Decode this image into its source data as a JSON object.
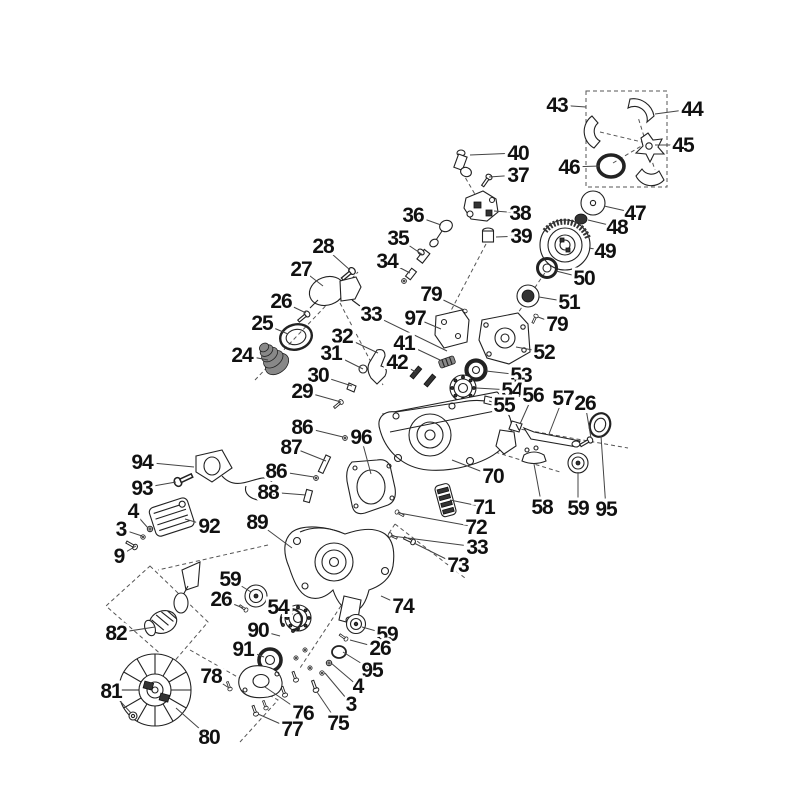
{
  "diagram": {
    "type": "exploded-parts-diagram",
    "background_color": "#ffffff",
    "line_color": "#222222",
    "label_color": "#111111",
    "labels": [
      {
        "text": "43",
        "x": 557,
        "y": 105,
        "tx": 586,
        "ty": 107
      },
      {
        "text": "44",
        "x": 692,
        "y": 109,
        "tx": 655,
        "ty": 114
      },
      {
        "text": "45",
        "x": 683,
        "y": 145,
        "tx": 655,
        "ty": 145
      },
      {
        "text": "46",
        "x": 569,
        "y": 167,
        "tx": 600,
        "ty": 166
      },
      {
        "text": "40",
        "x": 518,
        "y": 153,
        "tx": 470,
        "ty": 155
      },
      {
        "text": "37",
        "x": 518,
        "y": 175,
        "tx": 489,
        "ty": 177
      },
      {
        "text": "36",
        "x": 413,
        "y": 215,
        "tx": 441,
        "ty": 225
      },
      {
        "text": "38",
        "x": 520,
        "y": 213,
        "tx": 494,
        "ty": 211
      },
      {
        "text": "39",
        "x": 521,
        "y": 236,
        "tx": 496,
        "ty": 237
      },
      {
        "text": "35",
        "x": 398,
        "y": 238,
        "tx": 423,
        "ty": 255
      },
      {
        "text": "34",
        "x": 387,
        "y": 261,
        "tx": 410,
        "ty": 273
      },
      {
        "text": "28",
        "x": 323,
        "y": 246,
        "tx": 350,
        "ty": 270
      },
      {
        "text": "27",
        "x": 301,
        "y": 269,
        "tx": 323,
        "ty": 286
      },
      {
        "text": "26",
        "x": 281,
        "y": 301,
        "tx": 306,
        "ty": 313
      },
      {
        "text": "25",
        "x": 262,
        "y": 323,
        "tx": 288,
        "ty": 334
      },
      {
        "text": "24",
        "x": 242,
        "y": 355,
        "tx": 268,
        "ty": 360
      },
      {
        "text": "47",
        "x": 635,
        "y": 213,
        "tx": 604,
        "ty": 206
      },
      {
        "text": "48",
        "x": 617,
        "y": 227,
        "tx": 588,
        "ty": 220
      },
      {
        "text": "49",
        "x": 605,
        "y": 251,
        "tx": 589,
        "ty": 248
      },
      {
        "text": "50",
        "x": 584,
        "y": 278,
        "tx": 556,
        "ty": 271
      },
      {
        "text": "51",
        "x": 569,
        "y": 302,
        "tx": 539,
        "ty": 297
      },
      {
        "text": "79",
        "x": 557,
        "y": 324,
        "tx": 538,
        "ty": 317
      },
      {
        "text": "79",
        "x": 431,
        "y": 294,
        "tx": 464,
        "ty": 310
      },
      {
        "text": "97",
        "x": 415,
        "y": 318,
        "tx": 441,
        "ty": 329
      },
      {
        "text": "33",
        "x": 371,
        "y": 314,
        "tx": 447,
        "ty": 351
      },
      {
        "text": "32",
        "x": 342,
        "y": 336,
        "tx": 378,
        "ty": 353
      },
      {
        "text": "31",
        "x": 331,
        "y": 353,
        "tx": 363,
        "ty": 369
      },
      {
        "text": "30",
        "x": 318,
        "y": 375,
        "tx": 352,
        "ty": 386
      },
      {
        "text": "29",
        "x": 302,
        "y": 391,
        "tx": 341,
        "ty": 402
      },
      {
        "text": "41",
        "x": 404,
        "y": 343,
        "tx": 440,
        "ty": 360
      },
      {
        "text": "42",
        "x": 397,
        "y": 362,
        "tx": 416,
        "ty": 372
      },
      {
        "text": "52",
        "x": 544,
        "y": 352,
        "tx": 516,
        "ty": 347
      },
      {
        "text": "53",
        "x": 521,
        "y": 375,
        "tx": 486,
        "ty": 371
      },
      {
        "text": "54",
        "x": 512,
        "y": 390,
        "tx": 476,
        "ty": 388
      },
      {
        "text": "55",
        "x": 504,
        "y": 405,
        "tx": 489,
        "ty": 401
      },
      {
        "text": "56",
        "x": 533,
        "y": 395,
        "tx": 520,
        "ty": 424
      },
      {
        "text": "57",
        "x": 563,
        "y": 398,
        "tx": 549,
        "ty": 434
      },
      {
        "text": "26",
        "x": 585,
        "y": 403,
        "tx": 591,
        "ty": 438
      },
      {
        "text": "86",
        "x": 302,
        "y": 427,
        "tx": 343,
        "ty": 437
      },
      {
        "text": "96",
        "x": 361,
        "y": 437,
        "tx": 371,
        "ty": 474
      },
      {
        "text": "87",
        "x": 291,
        "y": 447,
        "tx": 326,
        "ty": 461
      },
      {
        "text": "86",
        "x": 276,
        "y": 471,
        "tx": 314,
        "ty": 477
      },
      {
        "text": "88",
        "x": 268,
        "y": 492,
        "tx": 306,
        "ty": 495
      },
      {
        "text": "70",
        "x": 493,
        "y": 476,
        "tx": 452,
        "ty": 460
      },
      {
        "text": "71",
        "x": 484,
        "y": 507,
        "tx": 450,
        "ty": 500
      },
      {
        "text": "72",
        "x": 476,
        "y": 527,
        "tx": 399,
        "ty": 513
      },
      {
        "text": "33",
        "x": 477,
        "y": 547,
        "tx": 392,
        "ty": 536
      },
      {
        "text": "73",
        "x": 458,
        "y": 565,
        "tx": 414,
        "ty": 543
      },
      {
        "text": "58",
        "x": 542,
        "y": 507,
        "tx": 534,
        "ty": 464
      },
      {
        "text": "59",
        "x": 578,
        "y": 508,
        "tx": 578,
        "ty": 472
      },
      {
        "text": "95",
        "x": 606,
        "y": 509,
        "tx": 601,
        "ty": 436
      },
      {
        "text": "94",
        "x": 142,
        "y": 462,
        "tx": 194,
        "ty": 467
      },
      {
        "text": "93",
        "x": 142,
        "y": 488,
        "tx": 176,
        "ty": 482
      },
      {
        "text": "4",
        "x": 133,
        "y": 511,
        "tx": 148,
        "ty": 528
      },
      {
        "text": "3",
        "x": 121,
        "y": 529,
        "tx": 142,
        "ty": 536
      },
      {
        "text": "9",
        "x": 119,
        "y": 556,
        "tx": 136,
        "ty": 546
      },
      {
        "text": "92",
        "x": 209,
        "y": 526,
        "tx": 185,
        "ty": 519
      },
      {
        "text": "89",
        "x": 257,
        "y": 522,
        "tx": 292,
        "ty": 548
      },
      {
        "text": "82",
        "x": 116,
        "y": 633,
        "tx": 155,
        "ty": 627
      },
      {
        "text": "59",
        "x": 230,
        "y": 579,
        "tx": 251,
        "ty": 592
      },
      {
        "text": "26",
        "x": 221,
        "y": 599,
        "tx": 243,
        "ty": 608
      },
      {
        "text": "54",
        "x": 278,
        "y": 607,
        "tx": 293,
        "ty": 614
      },
      {
        "text": "90",
        "x": 258,
        "y": 630,
        "tx": 280,
        "ty": 636
      },
      {
        "text": "91",
        "x": 243,
        "y": 649,
        "tx": 264,
        "ty": 657
      },
      {
        "text": "78",
        "x": 211,
        "y": 676,
        "tx": 229,
        "ty": 688
      },
      {
        "text": "81",
        "x": 111,
        "y": 691,
        "tx": 131,
        "ty": 713
      },
      {
        "text": "80",
        "x": 209,
        "y": 737,
        "tx": 176,
        "ty": 708
      },
      {
        "text": "74",
        "x": 403,
        "y": 606,
        "tx": 381,
        "ty": 596
      },
      {
        "text": "59",
        "x": 387,
        "y": 634,
        "tx": 362,
        "ty": 627
      },
      {
        "text": "26",
        "x": 380,
        "y": 648,
        "tx": 350,
        "ty": 640
      },
      {
        "text": "95",
        "x": 372,
        "y": 670,
        "tx": 343,
        "ty": 652
      },
      {
        "text": "4",
        "x": 358,
        "y": 686,
        "tx": 331,
        "ty": 663
      },
      {
        "text": "3",
        "x": 351,
        "y": 704,
        "tx": 325,
        "ty": 673
      },
      {
        "text": "76",
        "x": 303,
        "y": 713,
        "tx": 265,
        "ty": 687
      },
      {
        "text": "77",
        "x": 292,
        "y": 729,
        "tx": 258,
        "ty": 714
      },
      {
        "text": "75",
        "x": 338,
        "y": 723,
        "tx": 317,
        "ty": 692
      }
    ]
  }
}
